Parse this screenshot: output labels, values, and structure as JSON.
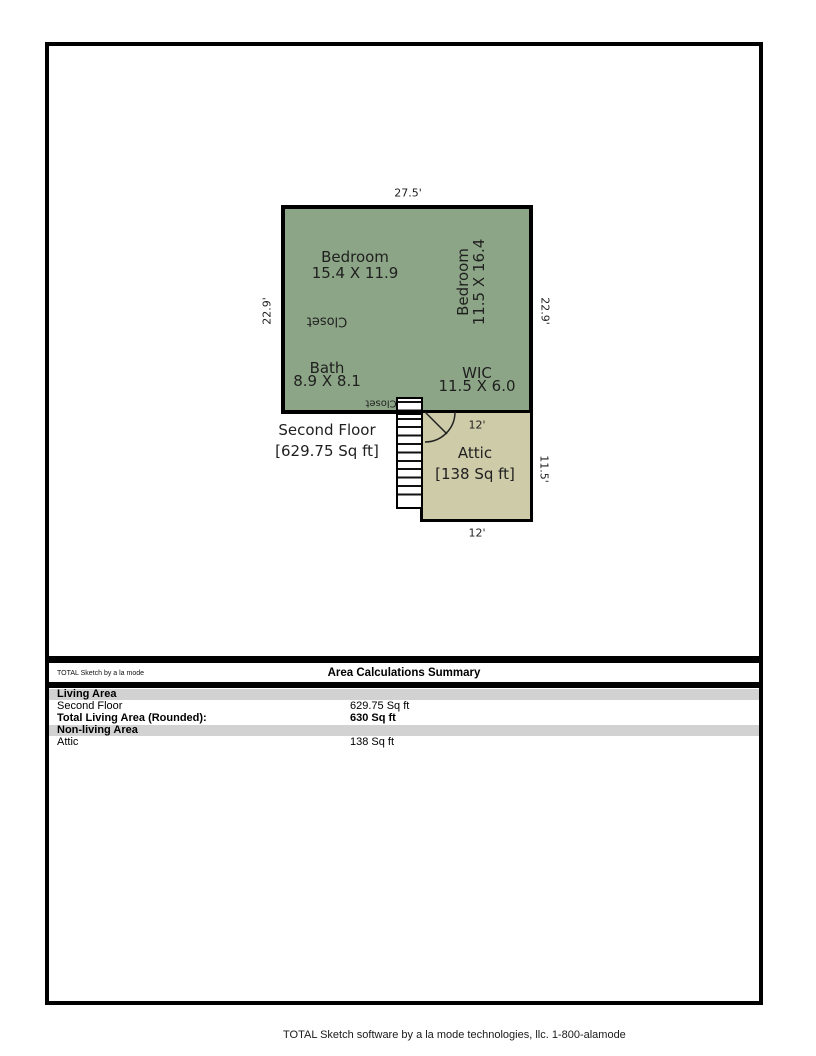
{
  "plan": {
    "floor_label": "Second Floor",
    "floor_area": "[629.75 Sq ft]",
    "dims": {
      "top": "27.5'",
      "left": "22.9'",
      "right": "22.9'",
      "attic_top": "12'",
      "attic_right": "11.5'",
      "attic_bottom": "12'"
    },
    "rooms": {
      "bedroom1_name": "Bedroom",
      "bedroom1_size": "15.4 X 11.9",
      "bedroom2_name": "Bedroom",
      "bedroom2_size": "11.5 X 16.4",
      "closet1": "Closet",
      "bath_name": "Bath",
      "bath_size": "8.9 X 8.1",
      "wic_name": "WIC",
      "wic_size": "11.5 X 6.0",
      "closet2": "Closet",
      "attic_name": "Attic",
      "attic_area": "[138 Sq ft]"
    },
    "colors": {
      "living_area_fill": "#8ca586",
      "attic_fill": "#cecba9",
      "wall": "#000000",
      "section_band": "#d2d2d2"
    }
  },
  "summary": {
    "brand": "TOTAL Sketch by a la mode",
    "title": "Area Calculations Summary",
    "sections": [
      {
        "header": "Living Area",
        "rows": [
          {
            "label": "Second Floor",
            "value": "629.75 Sq ft"
          },
          {
            "label": "Total Living Area (Rounded):",
            "value": "630 Sq ft"
          }
        ]
      },
      {
        "header": "Non-living Area",
        "rows": [
          {
            "label": "Attic",
            "value": "138 Sq ft"
          }
        ]
      }
    ]
  },
  "footer": {
    "text": "TOTAL Sketch software by a la mode technologies, llc. 1-800-alamode"
  }
}
